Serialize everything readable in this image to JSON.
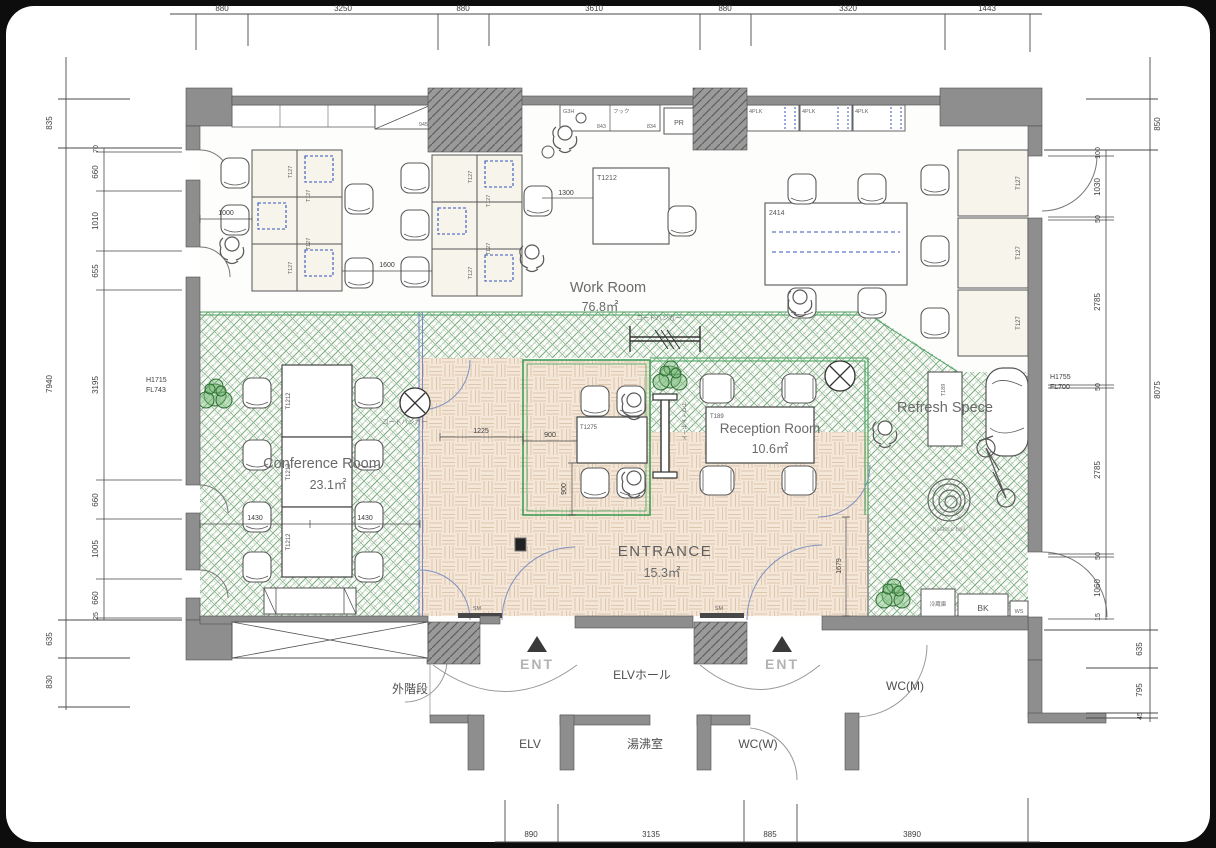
{
  "dims": {
    "top": [
      "880",
      "3250",
      "880",
      "3610",
      "880",
      "3320",
      "1443"
    ],
    "bottom": [
      "890",
      "3135",
      "885",
      "3890"
    ],
    "left_outer": [
      "835",
      "7940",
      "635",
      "830"
    ],
    "left_inner": [
      "70",
      "660",
      "1010",
      "655",
      "3195",
      "660",
      "1005",
      "660",
      "25"
    ],
    "right_outer": [
      "850",
      "8075"
    ],
    "right_bottom": [
      "635",
      "795",
      "45"
    ],
    "right_inner": [
      "100",
      "1030",
      "50",
      "2785",
      "50",
      "2785",
      "50",
      "1060",
      "15"
    ],
    "interior": {
      "d1000": "1000",
      "d1600": "1600",
      "d1300": "1300",
      "d1225": "1225",
      "d1430a": "1430",
      "d1430b": "1430",
      "d900a": "900",
      "d900b": "900",
      "d1679": "1679",
      "d945": "945",
      "d843": "843",
      "d834": "834"
    }
  },
  "annotations": {
    "left_h": "H1715",
    "left_fl": "FL743",
    "right_h": "H1755",
    "right_fl": "FL700"
  },
  "rooms": {
    "work": {
      "name": "Work Room",
      "area": "76.8㎡"
    },
    "conference": {
      "name": "Conference Room",
      "area": "23.1㎡"
    },
    "reception": {
      "name": "Reception Room",
      "area": "10.6㎡"
    },
    "entrance": {
      "name": "ENTRANCE",
      "area": "15.3㎡"
    },
    "refresh": {
      "name": "Refresh Spece"
    }
  },
  "labels": {
    "elv_hall": "ELVホール",
    "ext_stair": "外階段",
    "elv": "ELV",
    "hot_water": "湯沸室",
    "wc_w": "WC(W)",
    "wc_m": "WC(M)",
    "ent": "ENT",
    "coat_hanger": "コートハンガー",
    "whiteboard": "ホワイトボード",
    "balance_ball": "balance ball",
    "fridge": "冷蔵庫",
    "bk": "BK",
    "ws": "WS",
    "pr": "PR",
    "plk": "4PLK",
    "g3h": "G3H",
    "hook": "フック",
    "sm": "SM"
  },
  "furniture": {
    "t127": "T127",
    "t1212": "T1212",
    "t1275": "T1275",
    "t189": "T189",
    "t2414": "2414"
  }
}
